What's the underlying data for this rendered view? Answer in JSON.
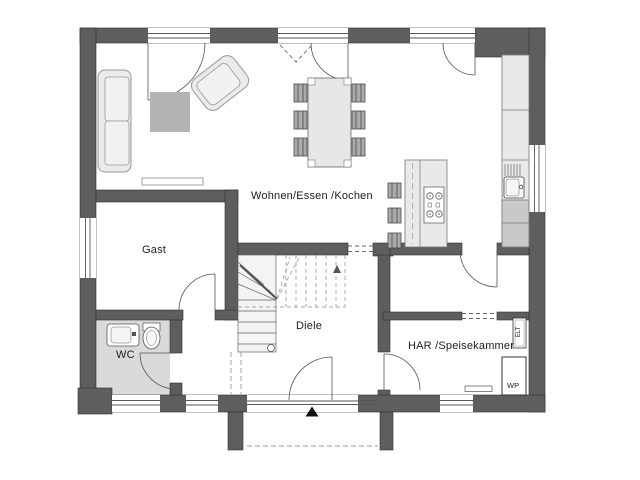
{
  "plan": {
    "title": "Erdgeschoss Grundriss",
    "rooms": [
      {
        "id": "wohnen",
        "label": "Wohnen/Essen /Kochen"
      },
      {
        "id": "gast",
        "label": "Gast"
      },
      {
        "id": "wc",
        "label": "WC"
      },
      {
        "id": "diele",
        "label": "Diele"
      },
      {
        "id": "har",
        "label": "HAR /Speisekammer"
      }
    ],
    "equipment": [
      {
        "id": "wp",
        "label": "WP"
      },
      {
        "id": "elt",
        "label": "ELT"
      }
    ],
    "markers": [
      {
        "id": "entrance-arrow",
        "symbol": "▲"
      }
    ],
    "colors": {
      "wall": "#5e5e5e",
      "floor": "#ffffff",
      "wc_floor": "#dadada",
      "furniture_light": "#ebebeb",
      "furniture_mid": "#b4b4b4",
      "counter_dark": "#c9c9c9",
      "line": "#555555",
      "text": "#1d1d1d"
    }
  }
}
